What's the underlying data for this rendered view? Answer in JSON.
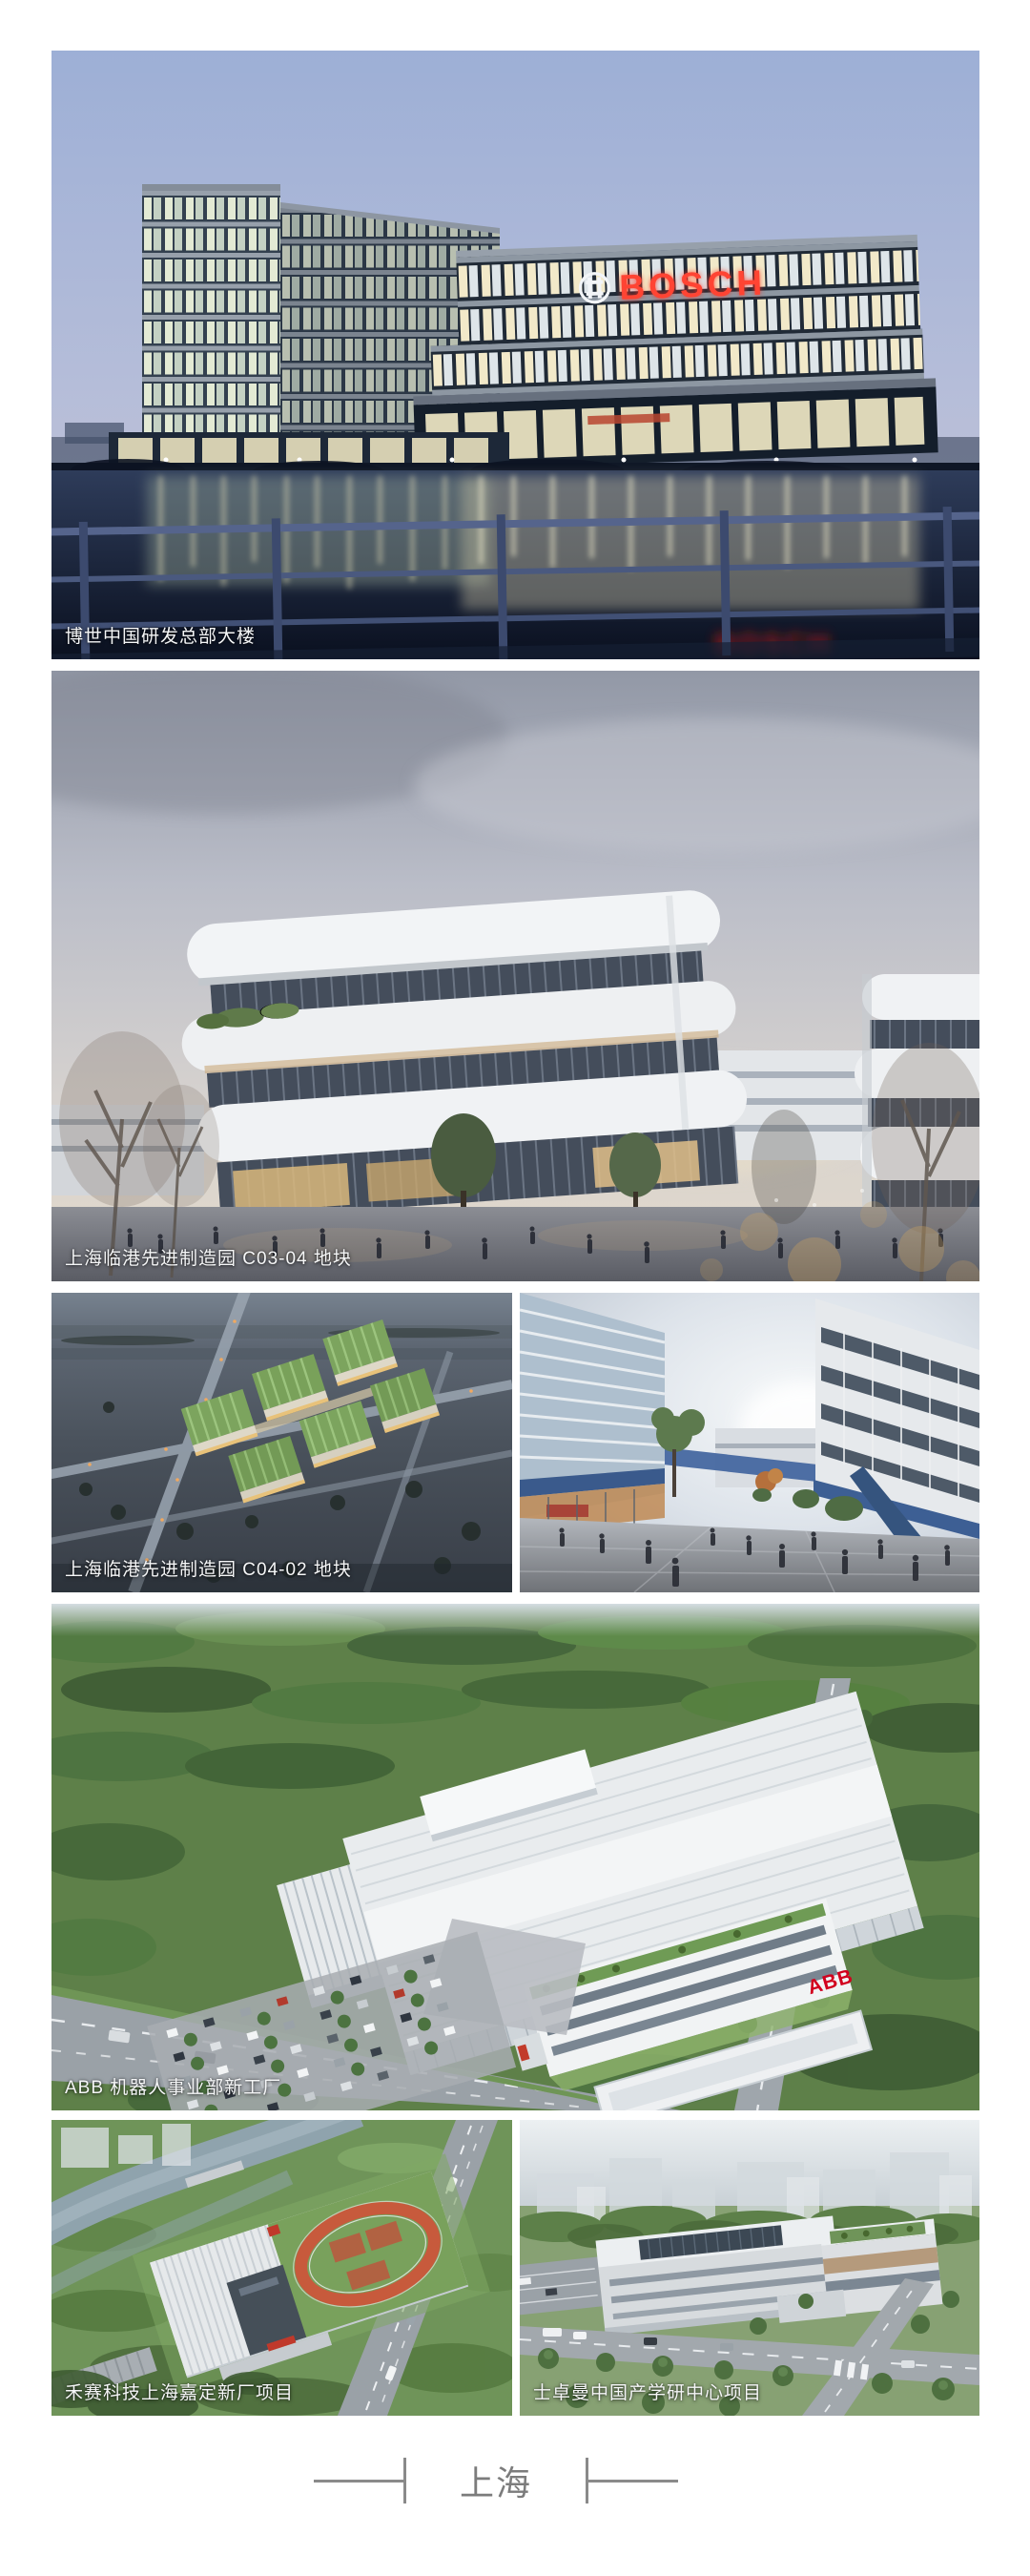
{
  "page": {
    "background": "#ffffff",
    "footer": {
      "city_label": "上海"
    }
  },
  "colors": {
    "caption_text": "#f5f6f7",
    "footer_text": "#7c7c7c",
    "divider_line": "#8a8a8a",
    "bosch_red": "#ff3322",
    "abb_red": "#d2001e"
  },
  "photos": {
    "bosch_hq": {
      "caption": "博世中国研发总部大楼",
      "sign_text": "BOSCH"
    },
    "lingang_c03_04": {
      "caption": "上海临港先进制造园 C03-04 地块"
    },
    "lingang_c04_02": {
      "caption": "上海临港先进制造园 C04-02 地块"
    },
    "abb_factory": {
      "caption": "ABB 机器人事业部新工厂",
      "facade_logo": "ABB"
    },
    "hesai_plant": {
      "caption": "禾赛科技上海嘉定新厂项目"
    },
    "straumann_center": {
      "caption": "士卓曼中国产学研中心项目"
    }
  }
}
